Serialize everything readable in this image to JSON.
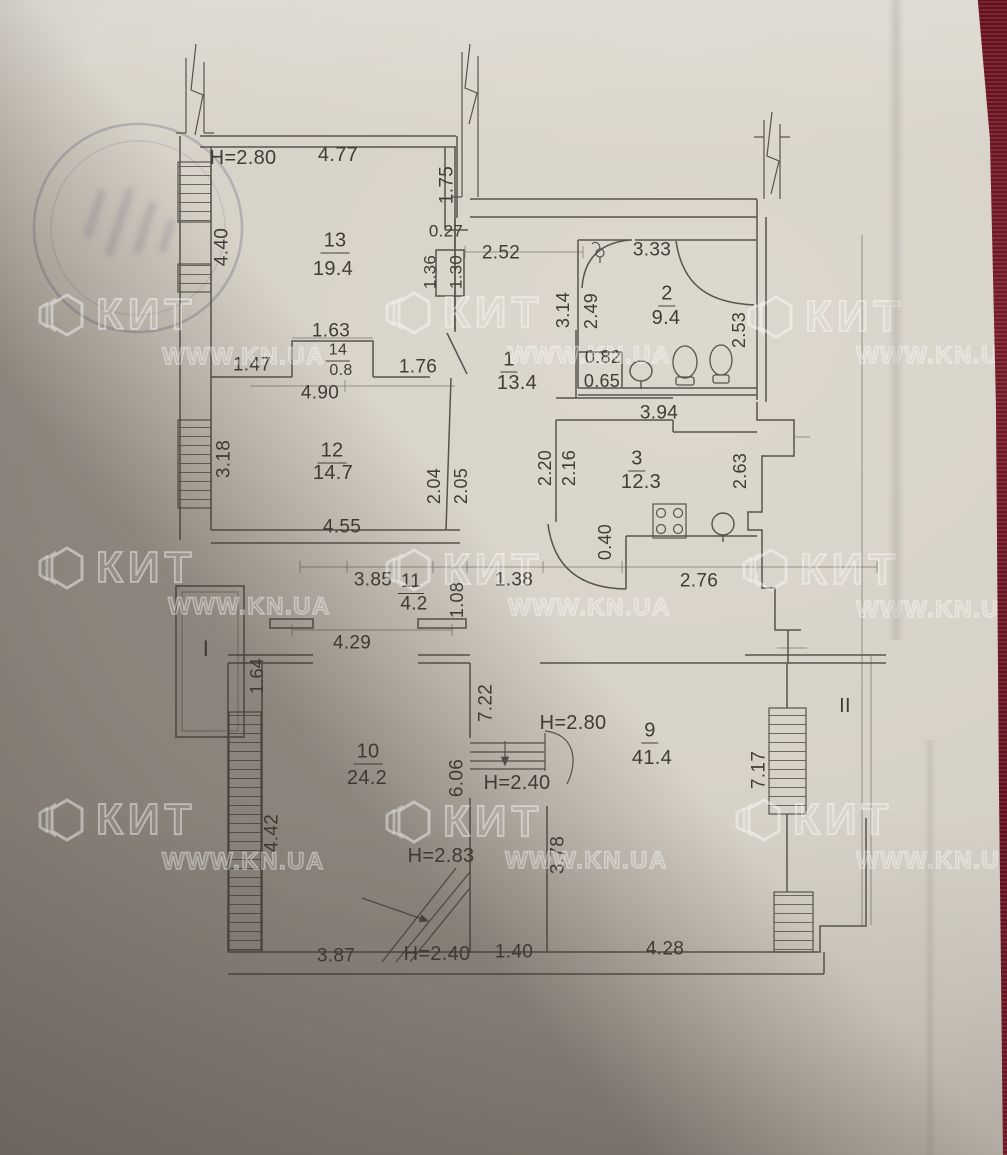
{
  "watermark": {
    "brand": "КИТ",
    "site": "WWW.KN.UA",
    "tiles": [
      {
        "lx": 36,
        "ly": 288,
        "sx": 162,
        "sy": 343
      },
      {
        "lx": 383,
        "ly": 286,
        "sx": 508,
        "sy": 342
      },
      {
        "lx": 745,
        "ly": 290,
        "sx": 856,
        "sy": 342
      },
      {
        "lx": 36,
        "ly": 541,
        "sx": 168,
        "sy": 593
      },
      {
        "lx": 383,
        "ly": 543,
        "sx": 508,
        "sy": 594
      },
      {
        "lx": 740,
        "ly": 543,
        "sx": 856,
        "sy": 596
      },
      {
        "lx": 36,
        "ly": 793,
        "sx": 162,
        "sy": 848
      },
      {
        "lx": 383,
        "ly": 795,
        "sx": 505,
        "sy": 847
      },
      {
        "lx": 733,
        "ly": 793,
        "sx": 856,
        "sy": 847
      }
    ]
  },
  "rooms": [
    {
      "number": "13",
      "area": "19.4"
    },
    {
      "number": "2",
      "area": "9.4"
    },
    {
      "number": "14",
      "area": "0.8"
    },
    {
      "number": "1",
      "area": "13.4"
    },
    {
      "number": "12",
      "area": "14.7"
    },
    {
      "number": "3",
      "area": "12.3"
    },
    {
      "number": "11",
      "area": "4.2"
    },
    {
      "number": "10",
      "area": "24.2"
    },
    {
      "number": "9",
      "area": "41.4"
    }
  ],
  "balconies": [
    "I",
    "II"
  ],
  "labels": [
    {
      "t": "H=2.80",
      "x": 243,
      "y": 158,
      "r": 0,
      "s": 20,
      "k": "height"
    },
    {
      "t": "4.77",
      "x": 338,
      "y": 155,
      "r": 0,
      "s": 20,
      "k": "dim"
    },
    {
      "t": "1.75",
      "x": 447,
      "y": 185,
      "r": -90,
      "s": 19,
      "k": "dim"
    },
    {
      "t": "4.40",
      "x": 222,
      "y": 247,
      "r": -90,
      "s": 19,
      "k": "dim"
    },
    {
      "t": "13",
      "x": 335,
      "y": 242,
      "r": 0,
      "s": 20,
      "k": "room"
    },
    {
      "t": "19.4",
      "x": 333,
      "y": 269,
      "r": 0,
      "s": 20,
      "k": "area"
    },
    {
      "t": "0.27",
      "x": 446,
      "y": 231,
      "r": 0,
      "s": 17,
      "k": "dim"
    },
    {
      "t": "2.52",
      "x": 501,
      "y": 253,
      "r": 0,
      "s": 19,
      "k": "dim"
    },
    {
      "t": "1.36",
      "x": 430,
      "y": 272,
      "r": -90,
      "s": 17,
      "k": "dim"
    },
    {
      "t": "1.30",
      "x": 456,
      "y": 272,
      "r": -90,
      "s": 17,
      "k": "dim"
    },
    {
      "t": "3.33",
      "x": 652,
      "y": 250,
      "r": 0,
      "s": 19,
      "k": "dim"
    },
    {
      "t": "2",
      "x": 667,
      "y": 295,
      "r": 0,
      "s": 20,
      "k": "room"
    },
    {
      "t": "9.4",
      "x": 666,
      "y": 318,
      "r": 0,
      "s": 20,
      "k": "area"
    },
    {
      "t": "3.14",
      "x": 563,
      "y": 310,
      "r": -90,
      "s": 18,
      "k": "dim"
    },
    {
      "t": "2.49",
      "x": 591,
      "y": 311,
      "r": -90,
      "s": 18,
      "k": "dim"
    },
    {
      "t": "2.53",
      "x": 739,
      "y": 330,
      "r": -90,
      "s": 18,
      "k": "dim"
    },
    {
      "t": "1.63",
      "x": 331,
      "y": 331,
      "r": 0,
      "s": 19,
      "k": "dim"
    },
    {
      "t": "14",
      "x": 338,
      "y": 352,
      "r": 0,
      "s": 16,
      "k": "room"
    },
    {
      "t": "0.8",
      "x": 341,
      "y": 371,
      "r": 0,
      "s": 16,
      "k": "area"
    },
    {
      "t": "1.47",
      "x": 252,
      "y": 365,
      "r": 0,
      "s": 19,
      "k": "dim"
    },
    {
      "t": "1.76",
      "x": 418,
      "y": 367,
      "r": 0,
      "s": 19,
      "k": "dim"
    },
    {
      "t": "4.90",
      "x": 320,
      "y": 393,
      "r": 0,
      "s": 19,
      "k": "dim"
    },
    {
      "t": "1",
      "x": 509,
      "y": 361,
      "r": 0,
      "s": 20,
      "k": "room"
    },
    {
      "t": "13.4",
      "x": 517,
      "y": 383,
      "r": 0,
      "s": 20,
      "k": "area"
    },
    {
      "t": "0.82",
      "x": 603,
      "y": 357,
      "r": 0,
      "s": 18,
      "k": "dim"
    },
    {
      "t": "0.65",
      "x": 602,
      "y": 381,
      "r": 0,
      "s": 18,
      "k": "dim"
    },
    {
      "t": "3.94",
      "x": 659,
      "y": 413,
      "r": 0,
      "s": 19,
      "k": "dim"
    },
    {
      "t": "3.18",
      "x": 224,
      "y": 459,
      "r": -90,
      "s": 19,
      "k": "dim"
    },
    {
      "t": "12",
      "x": 332,
      "y": 452,
      "r": 0,
      "s": 20,
      "k": "room"
    },
    {
      "t": "14.7",
      "x": 333,
      "y": 473,
      "r": 0,
      "s": 20,
      "k": "area"
    },
    {
      "t": "2.04",
      "x": 434,
      "y": 486,
      "r": -90,
      "s": 18,
      "k": "dim"
    },
    {
      "t": "2.05",
      "x": 461,
      "y": 486,
      "r": -90,
      "s": 18,
      "k": "dim"
    },
    {
      "t": "2.20",
      "x": 545,
      "y": 468,
      "r": -90,
      "s": 18,
      "k": "dim"
    },
    {
      "t": "2.16",
      "x": 569,
      "y": 468,
      "r": -90,
      "s": 18,
      "k": "dim"
    },
    {
      "t": "3",
      "x": 637,
      "y": 460,
      "r": 0,
      "s": 20,
      "k": "room"
    },
    {
      "t": "12.3",
      "x": 641,
      "y": 482,
      "r": 0,
      "s": 20,
      "k": "area"
    },
    {
      "t": "2.63",
      "x": 740,
      "y": 471,
      "r": -90,
      "s": 18,
      "k": "dim"
    },
    {
      "t": "4.55",
      "x": 342,
      "y": 527,
      "r": 0,
      "s": 19,
      "k": "dim"
    },
    {
      "t": "0.40",
      "x": 605,
      "y": 542,
      "r": -90,
      "s": 18,
      "k": "dim"
    },
    {
      "t": "3.85",
      "x": 373,
      "y": 580,
      "r": 0,
      "s": 19,
      "k": "dim"
    },
    {
      "t": "11",
      "x": 411,
      "y": 583,
      "r": 0,
      "s": 19,
      "k": "room"
    },
    {
      "t": "4.2",
      "x": 414,
      "y": 604,
      "r": 0,
      "s": 19,
      "k": "area"
    },
    {
      "t": "1.38",
      "x": 514,
      "y": 580,
      "r": 0,
      "s": 19,
      "k": "dim"
    },
    {
      "t": "2.76",
      "x": 699,
      "y": 581,
      "r": 0,
      "s": 19,
      "k": "dim"
    },
    {
      "t": "1.08",
      "x": 457,
      "y": 600,
      "r": -90,
      "s": 18,
      "k": "dim"
    },
    {
      "t": "4.29",
      "x": 352,
      "y": 643,
      "r": 0,
      "s": 19,
      "k": "dim"
    },
    {
      "t": "I",
      "x": 206,
      "y": 649,
      "r": 0,
      "s": 22,
      "k": "balcony"
    },
    {
      "t": "1.64",
      "x": 257,
      "y": 676,
      "r": -90,
      "s": 18,
      "k": "dim"
    },
    {
      "t": "7.22",
      "x": 486,
      "y": 703,
      "r": -90,
      "s": 19,
      "k": "dim"
    },
    {
      "t": "H=2.80",
      "x": 573,
      "y": 723,
      "r": 0,
      "s": 20,
      "k": "height"
    },
    {
      "t": "9",
      "x": 650,
      "y": 732,
      "r": 0,
      "s": 20,
      "k": "room"
    },
    {
      "t": "41.4",
      "x": 652,
      "y": 758,
      "r": 0,
      "s": 20,
      "k": "area"
    },
    {
      "t": "II",
      "x": 845,
      "y": 706,
      "r": 0,
      "s": 20,
      "k": "balcony"
    },
    {
      "t": "7.17",
      "x": 759,
      "y": 770,
      "r": -90,
      "s": 19,
      "k": "dim"
    },
    {
      "t": "10",
      "x": 368,
      "y": 753,
      "r": 0,
      "s": 20,
      "k": "room"
    },
    {
      "t": "24.2",
      "x": 367,
      "y": 778,
      "r": 0,
      "s": 20,
      "k": "area"
    },
    {
      "t": "6.06",
      "x": 457,
      "y": 778,
      "r": -90,
      "s": 19,
      "k": "dim"
    },
    {
      "t": "H=2.40",
      "x": 517,
      "y": 783,
      "r": 0,
      "s": 20,
      "k": "height"
    },
    {
      "t": "4.42",
      "x": 272,
      "y": 833,
      "r": -90,
      "s": 19,
      "k": "dim"
    },
    {
      "t": "H=2.83",
      "x": 441,
      "y": 856,
      "r": 0,
      "s": 20,
      "k": "height"
    },
    {
      "t": "3.78",
      "x": 558,
      "y": 855,
      "r": -90,
      "s": 19,
      "k": "dim"
    },
    {
      "t": "3.87",
      "x": 336,
      "y": 956,
      "r": 0,
      "s": 19,
      "k": "dim"
    },
    {
      "t": "H=2.40",
      "x": 437,
      "y": 954,
      "r": 0,
      "s": 20,
      "k": "height"
    },
    {
      "t": "1.40",
      "x": 514,
      "y": 952,
      "r": 0,
      "s": 19,
      "k": "dim"
    },
    {
      "t": "4.28",
      "x": 665,
      "y": 949,
      "r": 0,
      "s": 19,
      "k": "dim"
    }
  ]
}
